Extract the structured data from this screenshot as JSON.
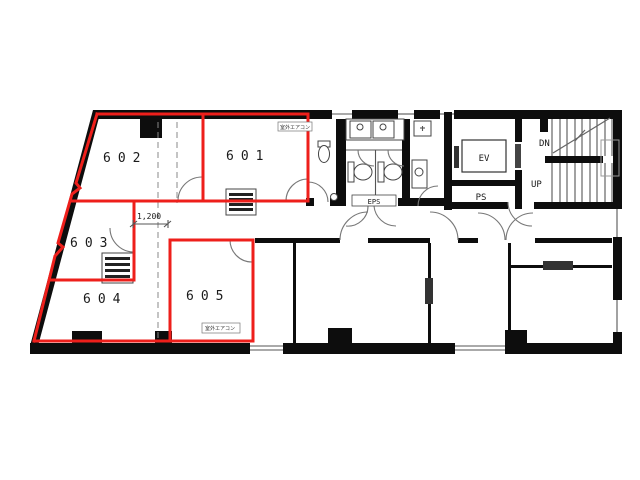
{
  "drawing": {
    "type": "building-floor-plan",
    "floor_units": [
      {
        "id": "601",
        "label": "601",
        "highlighted": true
      },
      {
        "id": "602",
        "label": "602",
        "highlighted": true
      },
      {
        "id": "603",
        "label": "603",
        "highlighted": true
      },
      {
        "id": "604",
        "label": "604",
        "highlighted": true
      },
      {
        "id": "605",
        "label": "605",
        "highlighted": true
      }
    ],
    "core_labels": {
      "elevator": "EV",
      "pipe_shaft": "PS",
      "electrical_shaft": "EPS",
      "stairs_down": "DN",
      "stairs_up": "UP"
    },
    "dimension_label": "1,200",
    "equipment_notes": {
      "top": "室外エアコン",
      "bottom": "室外エアコン"
    },
    "colors": {
      "unit_outline": "#ee1f1b",
      "wall": "#0d0d0d",
      "line": "#555555"
    }
  }
}
